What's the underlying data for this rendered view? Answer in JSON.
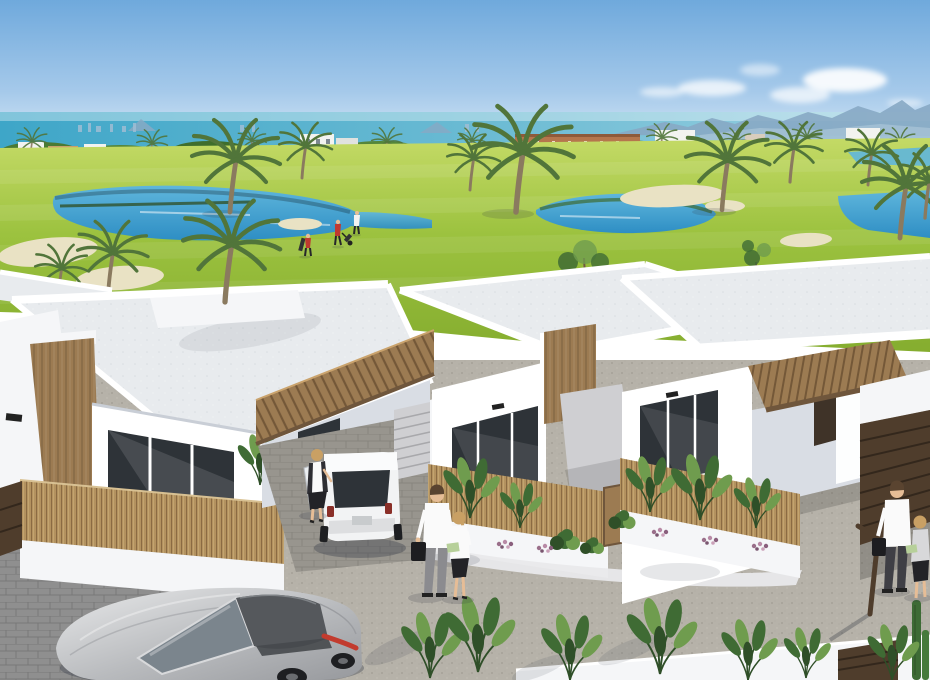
{
  "scene": {
    "type": "3d-architectural-render",
    "description": "New-build modern white villas with wood pergolas in front of a golf course with lakes, palm trees and sand bunkers; turquoise sea, distant city skyline and mountains on the horizon; gravel street in the foreground with a silver sports car, a white hatchback in a carport, pedestrians and golfers.",
    "sky": {
      "clouds": 5
    },
    "horizon": {
      "sea": "turquoise strip",
      "mountains_right": true,
      "buildings": [
        "terracotta apartment block",
        "white villas",
        "city towers"
      ]
    },
    "golf_course": {
      "lakes": 3,
      "sand_bunkers": 4,
      "palm_trees": 11,
      "golfers": 3
    },
    "villas": [
      {
        "id": "villa-left",
        "style": "white flat roof",
        "features": [
          "wood-clad column",
          "roof palm planter",
          "slatted carport pergola",
          "bamboo fence",
          "dark glazing"
        ]
      },
      {
        "id": "villa-center",
        "style": "white flat roof",
        "features": [
          "wood accent panel",
          "dark glazed doors",
          "external staircase",
          "wall lamp"
        ]
      },
      {
        "id": "villa-right",
        "style": "white flat roof",
        "features": [
          "slatted carport pergola",
          "dark slatted garage gate",
          "bamboo fence",
          "dark glazing"
        ]
      }
    ],
    "vehicles": [
      {
        "id": "sports-car",
        "color": "silver",
        "location": "foreground street"
      },
      {
        "id": "mini-hatchback",
        "color": "white",
        "location": "carport under left pergola"
      }
    ],
    "people": {
      "golfers": 3,
      "pedestrians": 5
    },
    "landscaping": [
      "banana plants",
      "purple flower beds",
      "white planter walls",
      "gravel driveway",
      "cobbled apron",
      "garden lamp post",
      "boundary wall with wooden gate",
      "columnar cactus"
    ]
  },
  "palette": {
    "sky_top": "#6fa9dc",
    "sky_mid": "#a5c9ea",
    "sky_horizon": "#ddecf8",
    "sea_deep": "#3ea6c8",
    "sea_light": "#9fd2e2",
    "skyline": "#9fbdd4",
    "mountain": "#87a9c4",
    "bldg_terracotta": "#b5764d",
    "bldg_white": "#f2f3f0",
    "grass_light": "#c4da66",
    "grass_mid": "#9cc23f",
    "grass_dark": "#85ad2f",
    "lake_light": "#5fb6dc",
    "lake": "#2e8ec4",
    "sand": "#e9e2c4",
    "villa_white": "#f5f6f8",
    "villa_face": "#ffffff",
    "villa_shadow": "#d9dde4",
    "roof": "#e8ebee",
    "wood": "#9c7b52",
    "wood_dark": "#6f563c",
    "wood_gate": "#4f3d2c",
    "bamboo": "#b3925f",
    "glass": "#2e3338",
    "gravel": "#b6b2a9",
    "cobble": "#8f8f8f",
    "concrete": "#cfcfd2",
    "car_silver": "#c9cacc",
    "car_roof": "#55585c",
    "car_red": "#c23b2e",
    "mini_white": "#f2f3f4",
    "skin": "#e6bd96",
    "hair_blonde": "#c9a064",
    "hair_brown": "#5a4430",
    "shirt_white": "#fafafa",
    "pants_grey": "#8b8b8f",
    "black": "#26262a",
    "red_shirt": "#c03a30",
    "foliage": "#3f6b34",
    "foliage_light": "#6f9c4e",
    "flower": "#9a6f8a",
    "palm_green": "#51753a",
    "palm_trunk": "#8a7a5f",
    "shadow": "rgba(50,55,70,0.35)"
  }
}
